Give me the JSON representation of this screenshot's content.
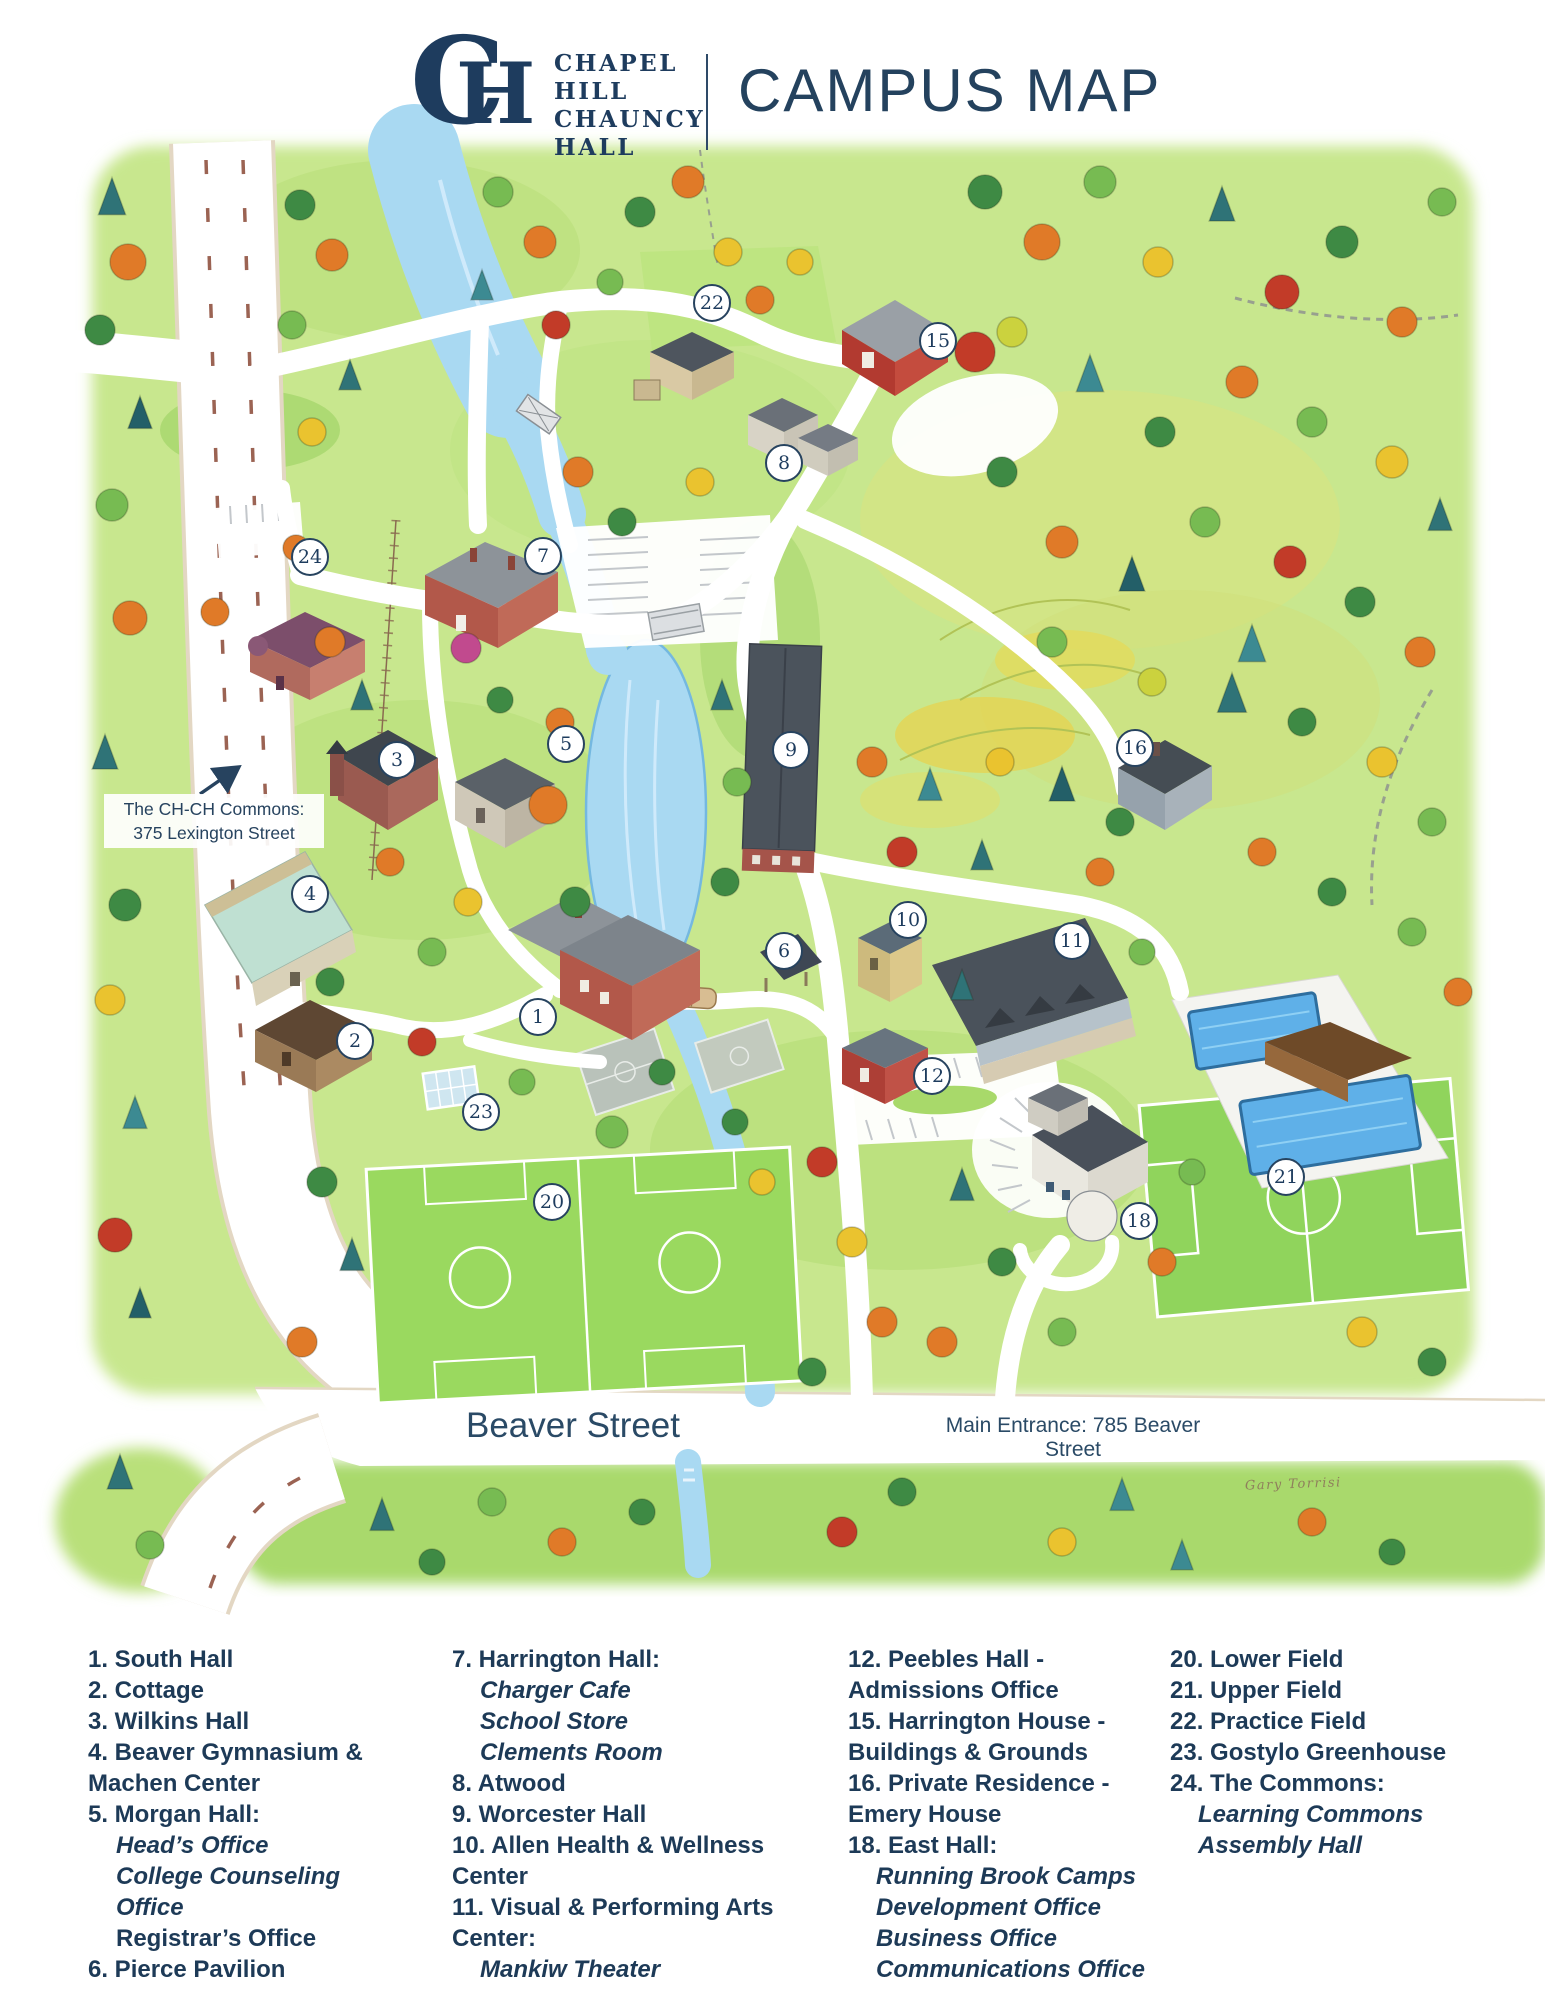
{
  "header": {
    "logo": {
      "monogram_c": "C",
      "monogram_h": "H",
      "school_lines": [
        "CHAPEL",
        "HILL",
        "CHAUNCY",
        "HALL"
      ]
    },
    "title": "CAMPUS MAP"
  },
  "map": {
    "annotations": {
      "commons_note_line1": "The CH-CH Commons:",
      "commons_note_line2": "375 Lexington Street",
      "beaver_street": "Beaver Street",
      "main_entrance": "Main Entrance: 785 Beaver Street",
      "artist_signature": "Gary Torrisi"
    },
    "markers": [
      {
        "number": "1",
        "x": 538,
        "y": 1017
      },
      {
        "number": "2",
        "x": 355,
        "y": 1041
      },
      {
        "number": "3",
        "x": 397,
        "y": 760
      },
      {
        "number": "4",
        "x": 310,
        "y": 894
      },
      {
        "number": "5",
        "x": 566,
        "y": 744
      },
      {
        "number": "6",
        "x": 784,
        "y": 951
      },
      {
        "number": "7",
        "x": 543,
        "y": 556
      },
      {
        "number": "8",
        "x": 784,
        "y": 463
      },
      {
        "number": "9",
        "x": 791,
        "y": 750
      },
      {
        "number": "10",
        "x": 908,
        "y": 920
      },
      {
        "number": "11",
        "x": 1072,
        "y": 941
      },
      {
        "number": "12",
        "x": 932,
        "y": 1076
      },
      {
        "number": "15",
        "x": 938,
        "y": 341
      },
      {
        "number": "16",
        "x": 1135,
        "y": 748
      },
      {
        "number": "18",
        "x": 1139,
        "y": 1221
      },
      {
        "number": "20",
        "x": 552,
        "y": 1202
      },
      {
        "number": "21",
        "x": 1286,
        "y": 1177
      },
      {
        "number": "22",
        "x": 712,
        "y": 303
      },
      {
        "number": "23",
        "x": 481,
        "y": 1112
      },
      {
        "number": "24",
        "x": 310,
        "y": 557
      }
    ]
  },
  "legend": {
    "columns": [
      {
        "items": [
          {
            "style": "main",
            "text": "1. South Hall"
          },
          {
            "style": "main",
            "text": "2. Cottage"
          },
          {
            "style": "main",
            "text": "3. Wilkins Hall"
          },
          {
            "style": "main",
            "text": "4. Beaver Gymnasium & Machen Center"
          },
          {
            "style": "main",
            "text": "5. Morgan Hall:"
          },
          {
            "style": "sub",
            "text": "Head’s Office"
          },
          {
            "style": "sub",
            "text": "College Counseling Office"
          },
          {
            "style": "subbold",
            "text": "Registrar’s Office"
          },
          {
            "style": "main",
            "text": "6. Pierce Pavilion"
          }
        ]
      },
      {
        "items": [
          {
            "style": "main",
            "text": "7. Harrington Hall:"
          },
          {
            "style": "sub",
            "text": "Charger Cafe"
          },
          {
            "style": "sub",
            "text": "School Store"
          },
          {
            "style": "sub",
            "text": "Clements Room"
          },
          {
            "style": "main",
            "text": "8. Atwood"
          },
          {
            "style": "main",
            "text": "9. Worcester Hall"
          },
          {
            "style": "main",
            "text": "10. Allen Health & Wellness Center"
          },
          {
            "style": "main",
            "text": "11. Visual & Performing Arts Center:"
          },
          {
            "style": "sub",
            "text": "Mankiw Theater"
          }
        ]
      },
      {
        "items": [
          {
            "style": "main",
            "text": "12. Peebles Hall - Admissions Office"
          },
          {
            "style": "main",
            "text": "15. Harrington House - Buildings & Grounds"
          },
          {
            "style": "main",
            "text": "16. Private Residence - Emery House"
          },
          {
            "style": "main",
            "text": "18. East Hall:"
          },
          {
            "style": "sub",
            "text": "Running Brook Camps"
          },
          {
            "style": "sub",
            "text": "Development Office"
          },
          {
            "style": "sub",
            "text": "Business Office"
          },
          {
            "style": "sub",
            "text": "Communications Office"
          }
        ]
      },
      {
        "items": [
          {
            "style": "main",
            "text": "20. Lower Field"
          },
          {
            "style": "main",
            "text": "21. Upper Field"
          },
          {
            "style": "main",
            "text": "22. Practice Field"
          },
          {
            "style": "main",
            "text": "23. Gostylo Greenhouse"
          },
          {
            "style": "main",
            "text": "24. The Commons:"
          },
          {
            "style": "sub",
            "text": "Learning Commons"
          },
          {
            "style": "sub",
            "text": "Assembly Hall"
          }
        ]
      }
    ]
  },
  "colors": {
    "navy": "#1e3c5e",
    "marker_border": "#27435f",
    "water": "#a9d9f2",
    "lawn": "#c8e78e"
  }
}
